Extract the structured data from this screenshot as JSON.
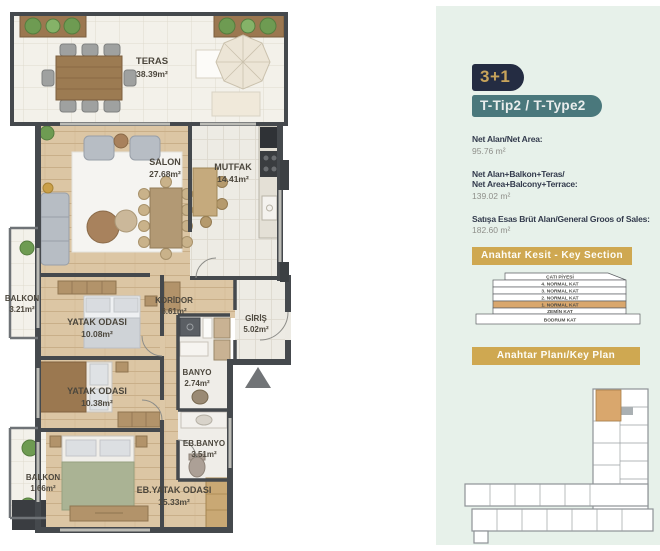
{
  "plan": {
    "rooms": [
      {
        "id": "teras",
        "name": "TERAS",
        "area": "38.39m²"
      },
      {
        "id": "salon",
        "name": "SALON",
        "area": "27.68m²"
      },
      {
        "id": "mutfak",
        "name": "MUTFAK",
        "area": "14.41m²"
      },
      {
        "id": "balkon-ust",
        "name": "BALKON",
        "area": "3.21m²"
      },
      {
        "id": "yatak-odasi-1",
        "name": "YATAK ODASI",
        "area": "10.08m²"
      },
      {
        "id": "koridor",
        "name": "KORİDOR",
        "area": "6.61m²"
      },
      {
        "id": "giris",
        "name": "GİRİŞ",
        "area": "5.02m²"
      },
      {
        "id": "banyo",
        "name": "BANYO",
        "area": "2.74m²"
      },
      {
        "id": "yatak-odasi-2",
        "name": "YATAK ODASI",
        "area": "10.38m²"
      },
      {
        "id": "eb-banyo",
        "name": "EB.BANYO",
        "area": "3.51m²"
      },
      {
        "id": "eb-yatak-odasi",
        "name": "EB.YATAK ODASI",
        "area": "15.33m²"
      },
      {
        "id": "balkon-alt",
        "name": "BALKON",
        "area": "1.66m²"
      }
    ]
  },
  "panel": {
    "type_badge": "3+1",
    "variant_badge": "T-Tip2 / T-Type2",
    "stats": [
      {
        "label_lines": {
          "0": "Net Alan/Net Area:"
        },
        "value": "95.76 m²"
      },
      {
        "label_lines": {
          "0": "Net Alan+Balkon+Teras/",
          "1": "Net Area+Balcony+Terrace:"
        },
        "value": "139.02 m²"
      },
      {
        "label_lines": {
          "0": "Satışa Esas Brüt Alan/General Groos of Sales:"
        },
        "value": "182.60 m²"
      }
    ],
    "key_section": {
      "title": "Anahtar Kesit - Key Section",
      "floors": [
        "ÇATI PİYESİ",
        "4. NORMAL KAT",
        "3. NORMAL KAT",
        "2. NORMAL KAT",
        "1. NORMAL KAT",
        "ZEMİN KAT",
        "BODRUM KAT"
      ],
      "highlighted_floor": "1. NORMAL KAT"
    },
    "key_plan": {
      "title": "Anahtar Planı/Key Plan"
    }
  },
  "colors": {
    "panel_bg": "#e7f1ea",
    "badge_navy": "#242c42",
    "badge_gold_text": "#c8a45b",
    "badge_teal": "#4a787c",
    "banner_gold": "#cfa851",
    "highlight_tan": "#d9a76d",
    "wall": "#45494d",
    "wood_floor": "#dcc6a4"
  }
}
